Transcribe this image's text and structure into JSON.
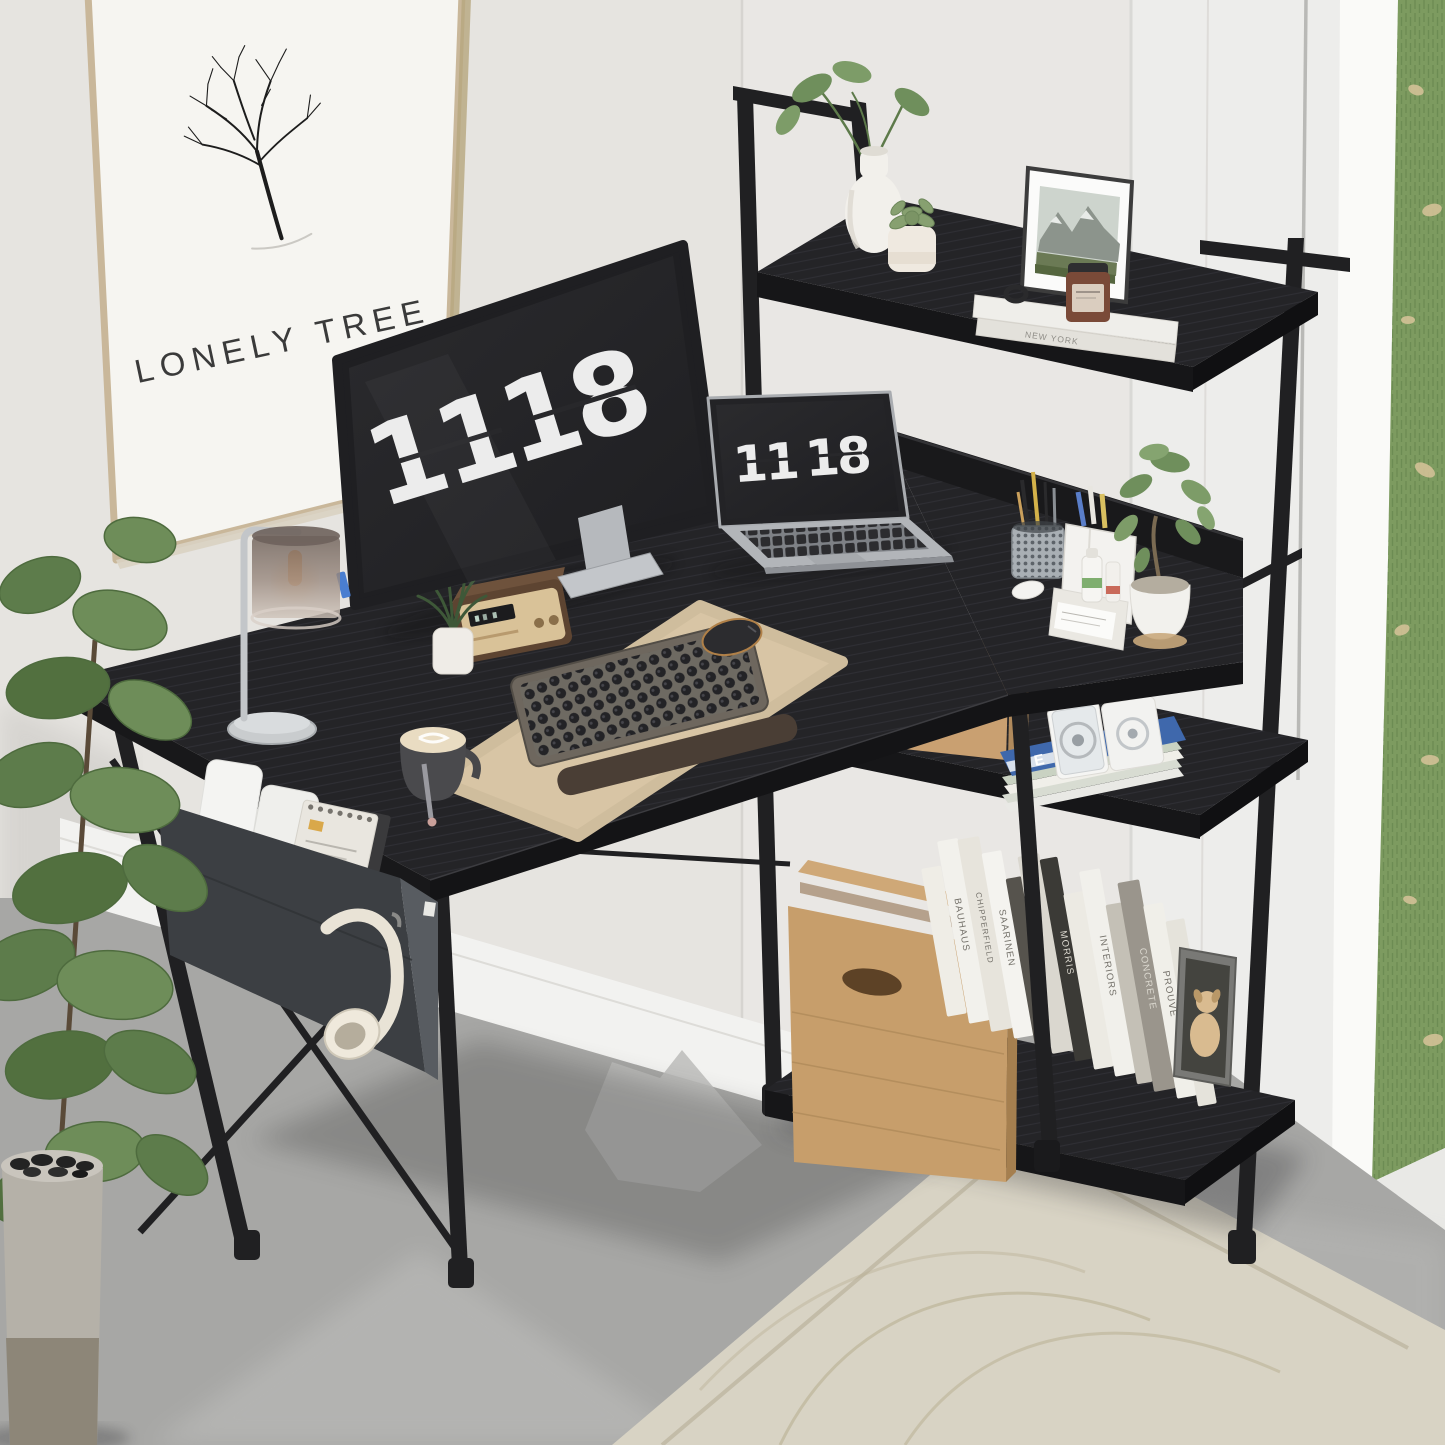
{
  "poster": {
    "title": "LONELY TREE"
  },
  "monitor": {
    "clock_hours": "11",
    "clock_minutes": "18"
  },
  "laptop": {
    "clock_hours": "11",
    "clock_minutes": "18"
  },
  "shelf": {
    "top_book_spine": "NEW YORK",
    "magazine_cover_letter": "E",
    "book_spines": [
      "BAUHAUS",
      "CHIPPERFIELD",
      "SAARINEN",
      "MORRIS",
      "INTERIORS",
      "CONCRETE",
      "PROUVÉ",
      "AALTO"
    ]
  },
  "colors": {
    "wall": "#e9e7e4",
    "desk_wood": "#242427",
    "metal_frame": "#202022",
    "poster_frame": "#c9b79a",
    "desk_mat": "#d8c5a5",
    "rug": "#d8d3c4",
    "floor": "#a7a7a5",
    "grass": "#7d9b60",
    "kraft_box": "#c79e6b",
    "storage_bag": "#3c3f43"
  }
}
